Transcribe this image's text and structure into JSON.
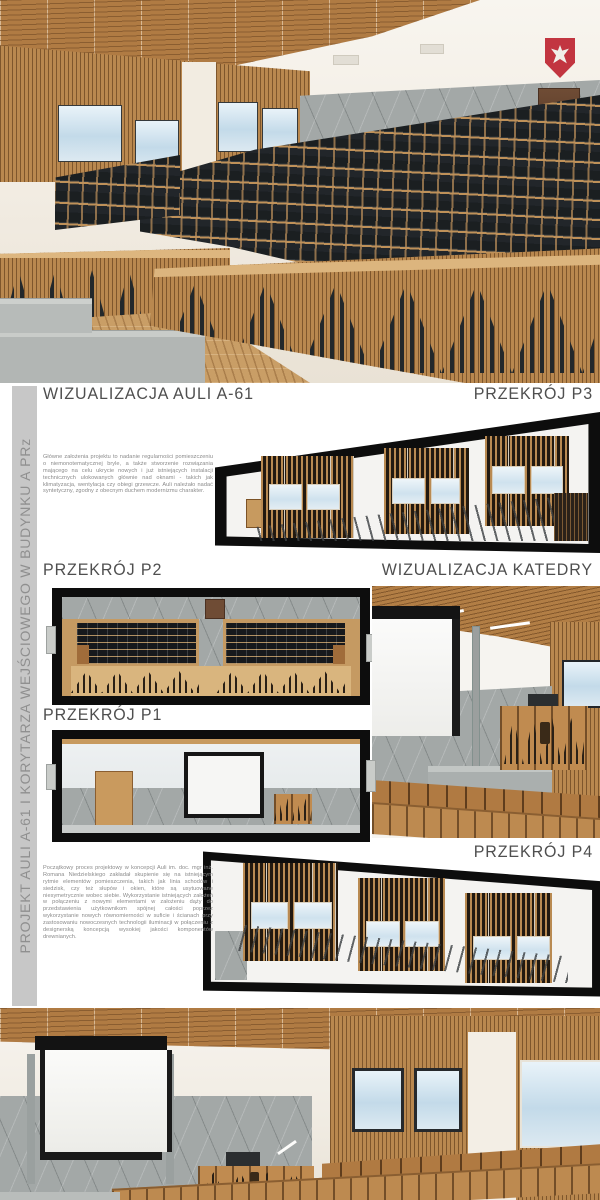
{
  "document": {
    "headings": {
      "visual_auli": "WIZUALIZACJA AULI A-61",
      "section_p3": "PRZEKRÓJ P3",
      "section_p2": "PRZEKRÓJ P2",
      "visual_katedra": "WIZUALIZACJA KATEDRY",
      "section_p1": "PRZEKRÓJ P1",
      "section_p4": "PRZEKRÓJ P4"
    },
    "sidebar_title": "PROJEKT AULI A-61 I KORYTARZA WEJŚCIOWEGO W BUDYNKU A PRz",
    "paragraphs": {
      "concept": "Główne założenia projektu to nadanie regularności pomieszczeniu o niemonotematycznej bryle, a także stworzenie rozwiązania mającego na celu ukrycie nowych i już istniejących instalacji technicznych ulokowanych głównie nad oknami - takich jak klimatyzacja, wentylacja czy obiegi grzewcze. Auli należało nadać syntetyczny, zgodny z obecnym duchem modernizmu charakter.",
      "process": "Początkowy proces projektowy w koncepcji Auli im. doc. mgr inż. Romana Niedzielskiego zakładał skupienie się na istniejącym rytmie elementów pomieszczenia, takich jak linia schodów i siedzisk, czy też słupów i okien, które są usytuowane niesymetrycznie wobec siebie. Wykorzystanie istniejących założeń w połączeniu z nowymi elementami w założeniu dąży do przedstawienia użytkownikom spójnej całości poprzez wykorzystanie nowych równomierności w suficie i ścianach przy zastosowaniu nowoczesnych technologii iluminacji w połączeniu z designerską koncepcją wysokiej jakości komponentów drewnianych."
    },
    "emblem": "polish-eagle",
    "colors": {
      "wood": "#b9884f",
      "wood_dark": "#8a5e31",
      "wall_cream": "#f3efe7",
      "concrete": "#a3a8a7",
      "seat_black": "#1e2225",
      "frame_black": "#0d0d0d",
      "emblem_red": "#c23540",
      "heading_gray": "#4f4f4f",
      "sidebar_bg": "#c7c7c7",
      "sidebar_text": "#8f8f8f"
    }
  }
}
